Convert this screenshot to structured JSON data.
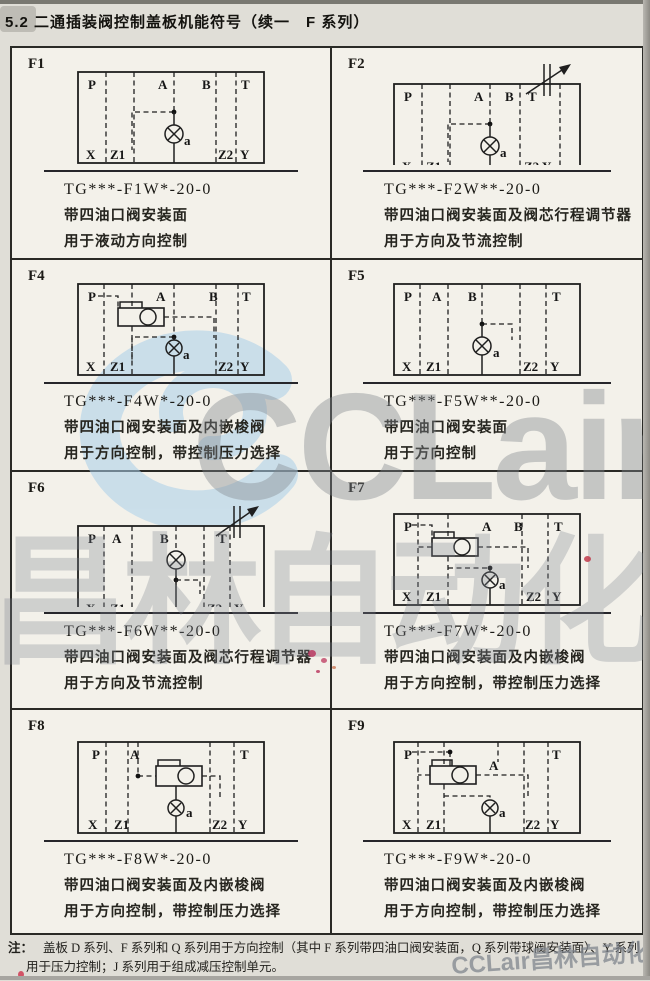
{
  "page": {
    "header": "5.2 二通插装阀控制盖板机能符号（续一　F 系列）",
    "note_label": "注：",
    "note_line1": "盖板 D 系列、F 系列和 Q 系列用于方向控制（其中 F 系列带四油口阀安装面，Q 系列带球阀安装面）、Y 系列",
    "note_line2": "用于压力控制；J 系列用于组成减压控制单元。"
  },
  "watermark": {
    "brand": "CCLair",
    "brand_cn": "昌林自动化",
    "footer": "CCLair昌林自动化",
    "logo_color": "#aacfe9",
    "text_color": "#82888e"
  },
  "colors": {
    "paper": "#f3f1ea",
    "page_bg": "#e0ded7",
    "line": "#1f1f1f",
    "red_mark": "#c13a4a"
  },
  "cells": [
    {
      "id": "F1",
      "model": "TG***-F1W*-20-0",
      "desc1": "带四油口阀安装面",
      "desc2": "用于液动方向控制",
      "ports": {
        "P": "P",
        "A": "A",
        "B": "B",
        "T": "T",
        "X": "X",
        "Z1": "Z1",
        "a": "a",
        "Z2": "Z2",
        "Y": "Y"
      }
    },
    {
      "id": "F2",
      "model": "TG***-F2W**-20-0",
      "desc1": "带四油口阀安装面及阀芯行程调节器",
      "desc2": "用于方向及节流控制",
      "ports": {
        "P": "P",
        "A": "A",
        "B": "B",
        "T": "T",
        "X": "X",
        "Z1": "Z1",
        "a": "a",
        "Z2": "Z2",
        "Y": "Y"
      }
    },
    {
      "id": "F4",
      "model": "TG***-F4W*-20-0",
      "desc1": "带四油口阀安装面及内嵌梭阀",
      "desc2": "用于方向控制，带控制压力选择",
      "ports": {
        "P": "P",
        "A": "A",
        "B": "B",
        "T": "T",
        "X": "X",
        "Z1": "Z1",
        "a": "a",
        "Z2": "Z2",
        "Y": "Y"
      }
    },
    {
      "id": "F5",
      "model": "TG***-F5W**-20-0",
      "desc1": "带四油口阀安装面",
      "desc2": "用于方向控制",
      "ports": {
        "P": "P",
        "A": "A",
        "B": "B",
        "T": "T",
        "X": "X",
        "Z1": "Z1",
        "a": "a",
        "Z2": "Z2",
        "Y": "Y"
      }
    },
    {
      "id": "F6",
      "model": "TG***-F6W**-20-0",
      "desc1": "带四油口阀安装面及阀芯行程调节器",
      "desc2": "用于方向及节流控制",
      "ports": {
        "P": "P",
        "A": "A",
        "B": "B",
        "T": "T",
        "X": "X",
        "Z1": "Z1",
        "a": "a",
        "Z2": "Z2",
        "Y": "Y"
      }
    },
    {
      "id": "F7",
      "model": "TG***-F7W*-20-0",
      "desc1": "带四油口阀安装面及内嵌梭阀",
      "desc2": "用于方向控制，带控制压力选择",
      "ports": {
        "P": "P",
        "A": "A",
        "B": "B",
        "T": "T",
        "X": "X",
        "Z1": "Z1",
        "a": "a",
        "Z2": "Z2",
        "Y": "Y"
      }
    },
    {
      "id": "F8",
      "model": "TG***-F8W*-20-0",
      "desc1": "带四油口阀安装面及内嵌梭阀",
      "desc2": "用于方向控制，带控制压力选择",
      "ports": {
        "P": "P",
        "A": "A",
        "T": "T",
        "X": "X",
        "Z1": "Z1",
        "a": "a",
        "Z2": "Z2",
        "Y": "Y"
      }
    },
    {
      "id": "F9",
      "model": "TG***-F9W*-20-0",
      "desc1": "带四油口阀安装面及内嵌梭阀",
      "desc2": "用于方向控制，带控制压力选择",
      "ports": {
        "P": "P",
        "A": "A",
        "T": "T",
        "X": "X",
        "Z1": "Z1",
        "a": "a",
        "Z2": "Z2",
        "Y": "Y"
      }
    }
  ]
}
